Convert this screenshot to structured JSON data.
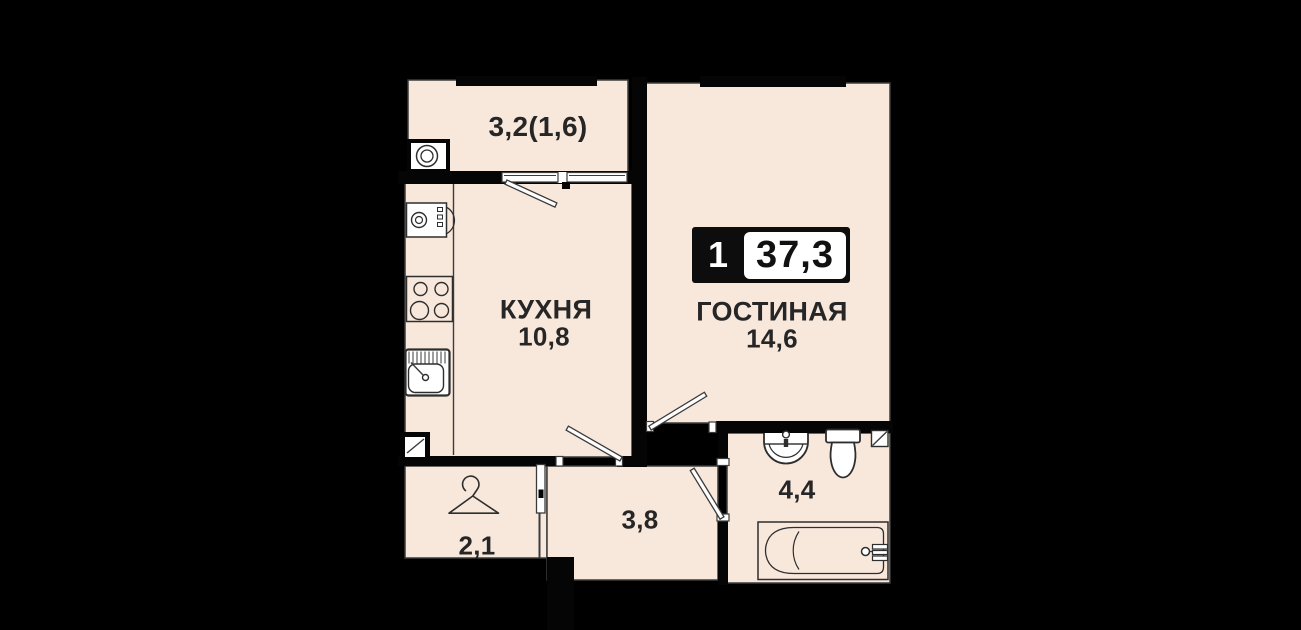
{
  "plan": {
    "title": "apartment-floor-plan",
    "colors": {
      "background": "#000000",
      "floor": "#f8e8dc",
      "wall": "#050505",
      "line": "#3b3b3b",
      "text": "#262626"
    },
    "badge": {
      "rooms": "1",
      "area_total": "37,3"
    },
    "rooms": [
      {
        "id": "balcony",
        "label": "",
        "area": "3,2(1,6)"
      },
      {
        "id": "kitchen",
        "label": "КУХНЯ",
        "area": "10,8"
      },
      {
        "id": "living",
        "label": "ГОСТИНАЯ",
        "area": "14,6"
      },
      {
        "id": "bathroom",
        "label": "",
        "area": "4,4"
      },
      {
        "id": "hallway",
        "label": "",
        "area": "3,8"
      },
      {
        "id": "entry",
        "label": "",
        "area": "2,1"
      }
    ],
    "icons": [
      "washing-machine-icon",
      "kitchen-appliance-icon",
      "stove-icon",
      "kitchen-sink-icon",
      "vent-shaft-icon",
      "hanger-icon",
      "bath-sink-icon",
      "toilet-icon",
      "bathtub-icon",
      "window-icon",
      "door-leaf-icon"
    ]
  }
}
